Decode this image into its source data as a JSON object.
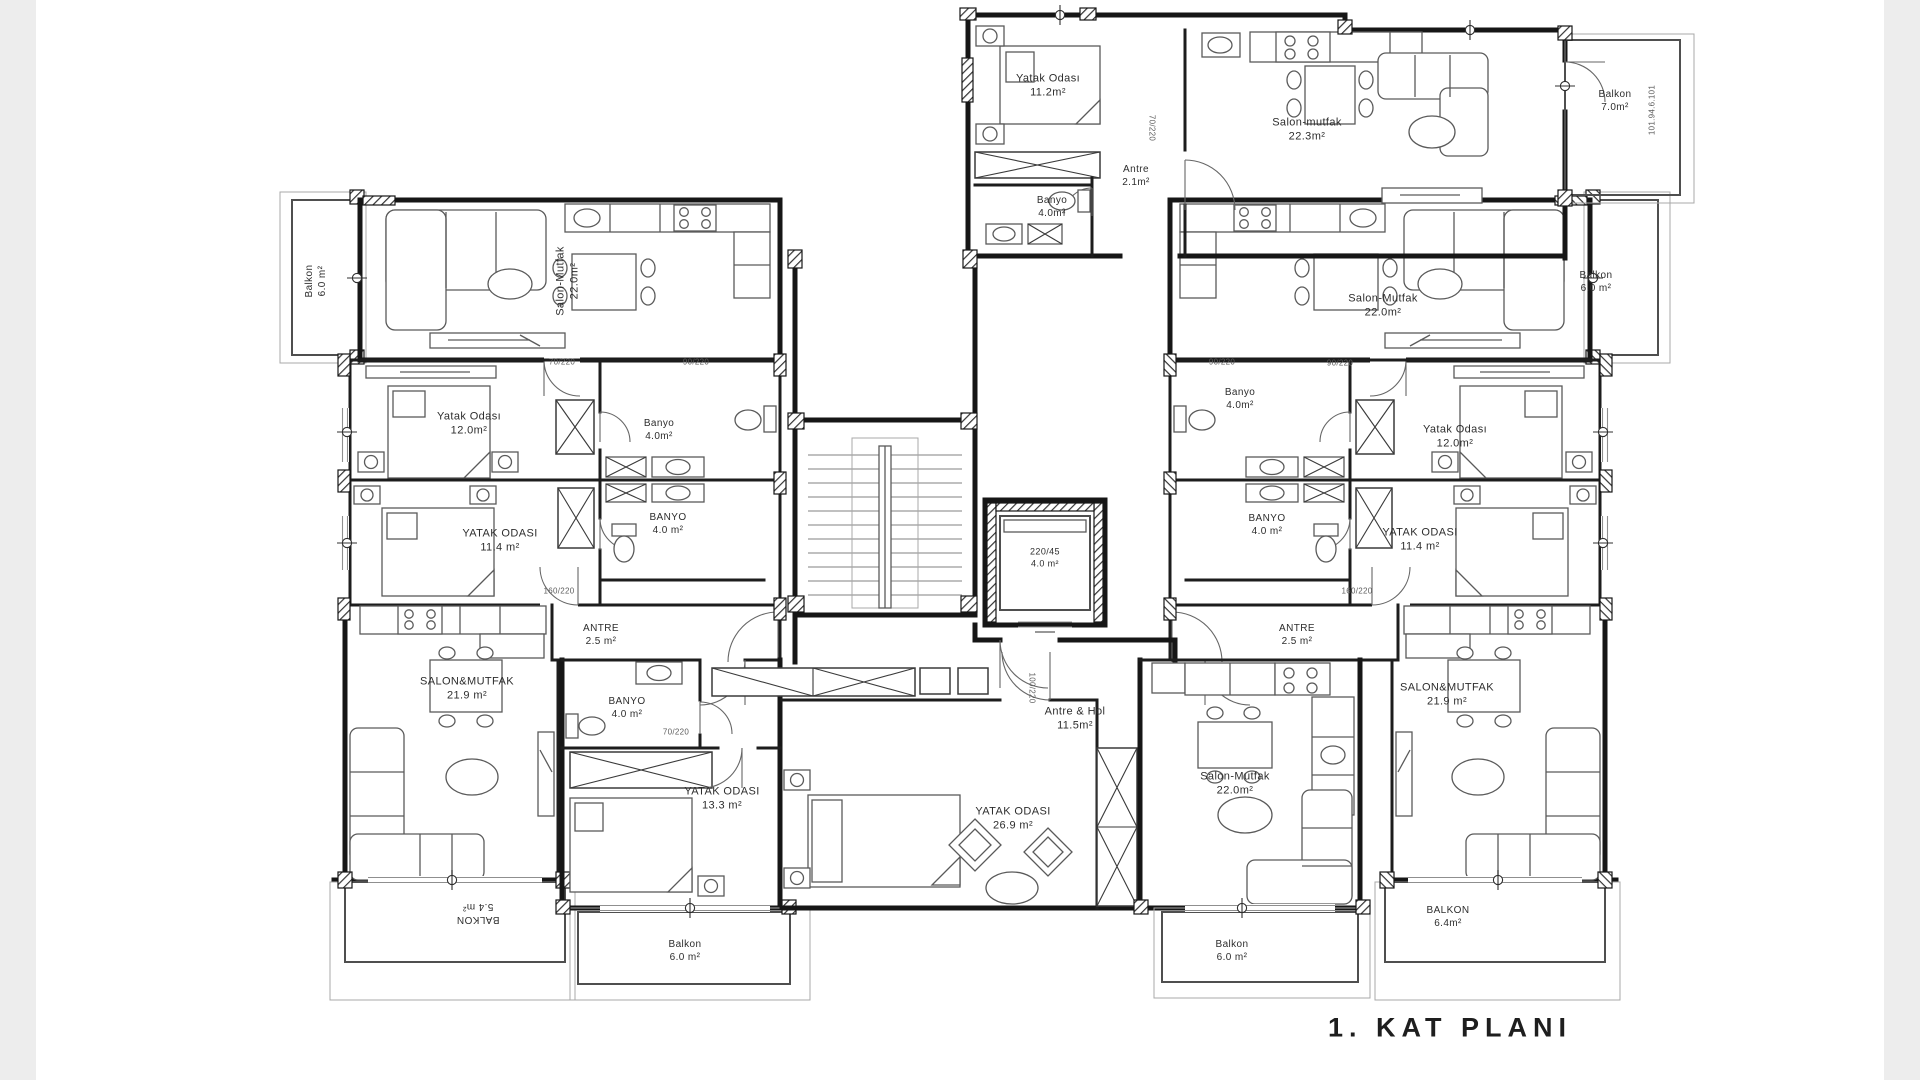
{
  "title": "1. KAT PLANI",
  "colors": {
    "wall": "#161616",
    "furniture": "#5a5a5a",
    "background": "#ffffff",
    "margin_band": "#ededed"
  },
  "core": {
    "stairs": "stair-flight",
    "elevator_line1": "220/45",
    "elevator_line2": "4.0 m²"
  },
  "rooms": [
    {
      "id": "yatak-odasi-top",
      "name": "Yatak Odası",
      "area": "11.2m²",
      "x": 1048,
      "y": 86,
      "r": 0,
      "s": 11
    },
    {
      "id": "antre-top",
      "name": "Antre",
      "area": "2.1m²",
      "x": 1136,
      "y": 176,
      "r": 0,
      "s": 10
    },
    {
      "id": "banyo-top",
      "name": "Banyo",
      "area": "4.0m²",
      "x": 1052,
      "y": 207,
      "r": 0,
      "s": 10
    },
    {
      "id": "salon-mutfak-top",
      "name": "Salon-mutfak",
      "area": "22.3m²",
      "x": 1307,
      "y": 130,
      "r": 0,
      "s": 11
    },
    {
      "id": "balkon-7",
      "name": "Balkon",
      "area": "7.0m²",
      "x": 1615,
      "y": 101,
      "r": 0,
      "s": 10
    },
    {
      "id": "salon-mutfak-topleft",
      "name": "Salon-Mutfak",
      "area": "22.0m²",
      "x": 568,
      "y": 281,
      "r": -90,
      "s": 11
    },
    {
      "id": "balkon-topleft",
      "name": "Balkon",
      "area": "6.0 m²",
      "x": 316,
      "y": 281,
      "r": -90,
      "s": 10
    },
    {
      "id": "yatak-odasi-left-12",
      "name": "Yatak Odası",
      "area": "12.0m²",
      "x": 469,
      "y": 424,
      "r": 0,
      "s": 11
    },
    {
      "id": "banyo-left-1",
      "name": "Banyo",
      "area": "4.0m²",
      "x": 659,
      "y": 430,
      "r": 0,
      "s": 10
    },
    {
      "id": "yatak-odasi-left-114",
      "name": "YATAK ODASI",
      "area": "11.4 m²",
      "x": 500,
      "y": 541,
      "r": 0,
      "s": 11
    },
    {
      "id": "banyo-left-2",
      "name": "BANYO",
      "area": "4.0 m²",
      "x": 668,
      "y": 524,
      "r": 0,
      "s": 10
    },
    {
      "id": "antre-left",
      "name": "ANTRE",
      "area": "2.5 m²",
      "x": 601,
      "y": 635,
      "r": 0,
      "s": 10
    },
    {
      "id": "salon-mutfak-left-219",
      "name": "SALON&MUTFAK",
      "area": "21.9 m²",
      "x": 467,
      "y": 689,
      "r": 0,
      "s": 11
    },
    {
      "id": "banyo-left-3",
      "name": "BANYO",
      "area": "4.0 m²",
      "x": 627,
      "y": 708,
      "r": 0,
      "s": 10
    },
    {
      "id": "yatak-odasi-133",
      "name": "YATAK ODASI",
      "area": "13.3 m²",
      "x": 722,
      "y": 799,
      "r": 0,
      "s": 11
    },
    {
      "id": "balkon-54",
      "name": "BALKON",
      "area": "5.4 m²",
      "x": 478,
      "y": 913,
      "r": 180,
      "s": 10
    },
    {
      "id": "balkon-left-6",
      "name": "Balkon",
      "area": "6.0 m²",
      "x": 685,
      "y": 951,
      "r": 0,
      "s": 10
    },
    {
      "id": "antre-hol",
      "name": "Antre & Hol",
      "area": "11.5m²",
      "x": 1075,
      "y": 719,
      "r": 0,
      "s": 11
    },
    {
      "id": "yatak-odasi-269",
      "name": "YATAK ODASI",
      "area": "26.9 m²",
      "x": 1013,
      "y": 819,
      "r": 0,
      "s": 11
    },
    {
      "id": "salon-mutfak-center-22",
      "name": "Salon-Mutfak",
      "area": "22.0m²",
      "x": 1235,
      "y": 784,
      "r": 0,
      "s": 11
    },
    {
      "id": "balkon-center-6",
      "name": "Balkon",
      "area": "6.0 m²",
      "x": 1232,
      "y": 951,
      "r": 0,
      "s": 10
    },
    {
      "id": "antre-right",
      "name": "ANTRE",
      "area": "2.5 m²",
      "x": 1297,
      "y": 635,
      "r": 0,
      "s": 10
    },
    {
      "id": "salon-mutfak-right-219",
      "name": "SALON&MUTFAK",
      "area": "21.9 m²",
      "x": 1447,
      "y": 695,
      "r": 0,
      "s": 11
    },
    {
      "id": "balkon-64",
      "name": "BALKON",
      "area": "6.4m²",
      "x": 1448,
      "y": 917,
      "r": 0,
      "s": 10
    },
    {
      "id": "banyo-right-1",
      "name": "Banyo",
      "area": "4.0m²",
      "x": 1240,
      "y": 399,
      "r": 0,
      "s": 10
    },
    {
      "id": "yatak-odasi-right-12",
      "name": "Yatak Odası",
      "area": "12.0m²",
      "x": 1455,
      "y": 437,
      "r": 0,
      "s": 11
    },
    {
      "id": "banyo-right-2",
      "name": "BANYO",
      "area": "4.0 m²",
      "x": 1267,
      "y": 525,
      "r": 0,
      "s": 10
    },
    {
      "id": "yatak-odasi-right-114",
      "name": "YATAK ODASI",
      "area": "11.4 m²",
      "x": 1420,
      "y": 540,
      "r": 0,
      "s": 11
    },
    {
      "id": "salon-mutfak-topright",
      "name": "Salon-Mutfak",
      "area": "22.0m²",
      "x": 1383,
      "y": 306,
      "r": 0,
      "s": 11
    },
    {
      "id": "balkon-topright",
      "name": "Balkon",
      "area": "6.0 m²",
      "x": 1596,
      "y": 282,
      "r": 0,
      "s": 10
    },
    {
      "id": "elevator",
      "name": "220/45",
      "area": "4.0 m²",
      "x": 1045,
      "y": 558,
      "r": 0,
      "s": 9
    }
  ],
  "annotations": [
    {
      "text": "70/220",
      "x": 562,
      "y": 362,
      "r": 0
    },
    {
      "text": "90/220",
      "x": 696,
      "y": 362,
      "r": 0
    },
    {
      "text": "90/220",
      "x": 1222,
      "y": 362,
      "r": 0
    },
    {
      "text": "90/220",
      "x": 1340,
      "y": 363,
      "r": 0
    },
    {
      "text": "160/220",
      "x": 559,
      "y": 591,
      "r": 0
    },
    {
      "text": "160/220",
      "x": 1357,
      "y": 591,
      "r": 0
    },
    {
      "text": "100/220",
      "x": 1032,
      "y": 688,
      "r": 90
    },
    {
      "text": "70/220",
      "x": 676,
      "y": 732,
      "r": 0
    },
    {
      "text": "70/220",
      "x": 1152,
      "y": 128,
      "r": 90
    },
    {
      "text": "101.94.6.101",
      "x": 1652,
      "y": 110,
      "r": -90
    }
  ]
}
